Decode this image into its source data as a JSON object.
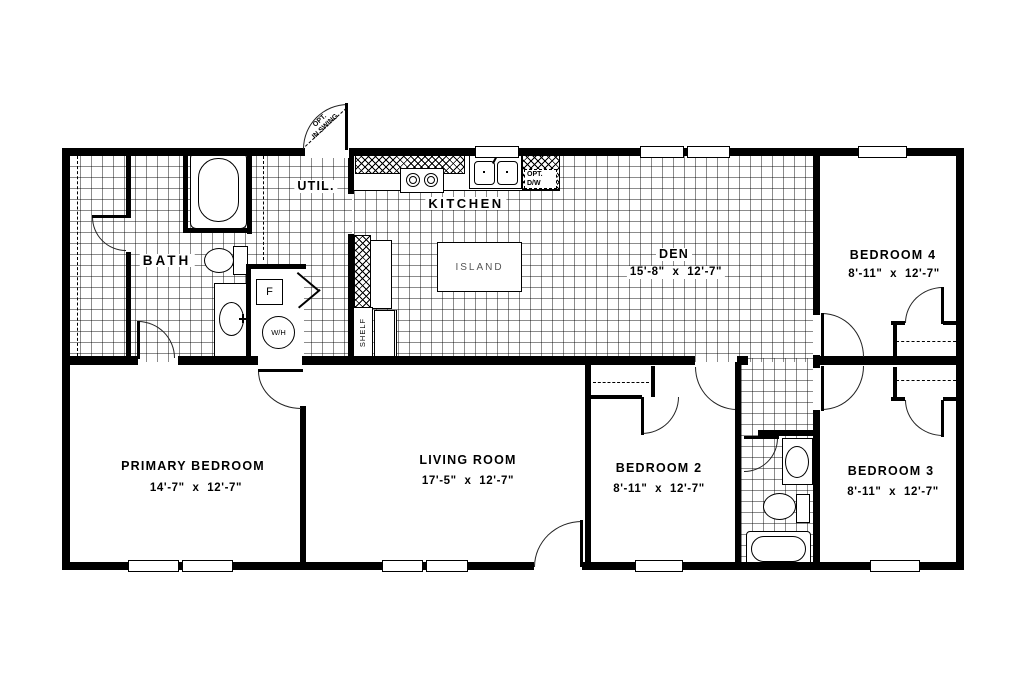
{
  "plan_title": "4-bedroom single-story floor plan",
  "rooms": {
    "bath": {
      "name": "BATH"
    },
    "util": {
      "name": "UTIL."
    },
    "kitchen": {
      "name": "KITCHEN"
    },
    "island": {
      "name": "ISLAND"
    },
    "den": {
      "name": "DEN",
      "dims": "15'-8\" x 12'-7\""
    },
    "bedroom4": {
      "name": "BEDROOM 4",
      "dims": "8'-11\" x 12'-7\""
    },
    "primary": {
      "name": "PRIMARY BEDROOM",
      "dims": "14'-7\" x 12'-7\""
    },
    "living": {
      "name": "LIVING ROOM",
      "dims": "17'-5\" x 12'-7\""
    },
    "bedroom2": {
      "name": "BEDROOM 2",
      "dims": "8'-11\" x 12'-7\""
    },
    "bedroom3": {
      "name": "BEDROOM 3",
      "dims": "8'-11\" x 12'-7\""
    }
  },
  "labels": {
    "shelf": "SHELF",
    "furnace": "F",
    "water_heater": "W/H",
    "opt_dw_line1": "OPT.",
    "opt_dw_line2": "D/W",
    "opt_inswing_line1": "OPT.",
    "opt_inswing_line2": "IN SWING"
  },
  "colors": {
    "wall": "#000000",
    "floor": "#ffffff",
    "tile_grid": "rgba(0,0,0,0.45)"
  }
}
